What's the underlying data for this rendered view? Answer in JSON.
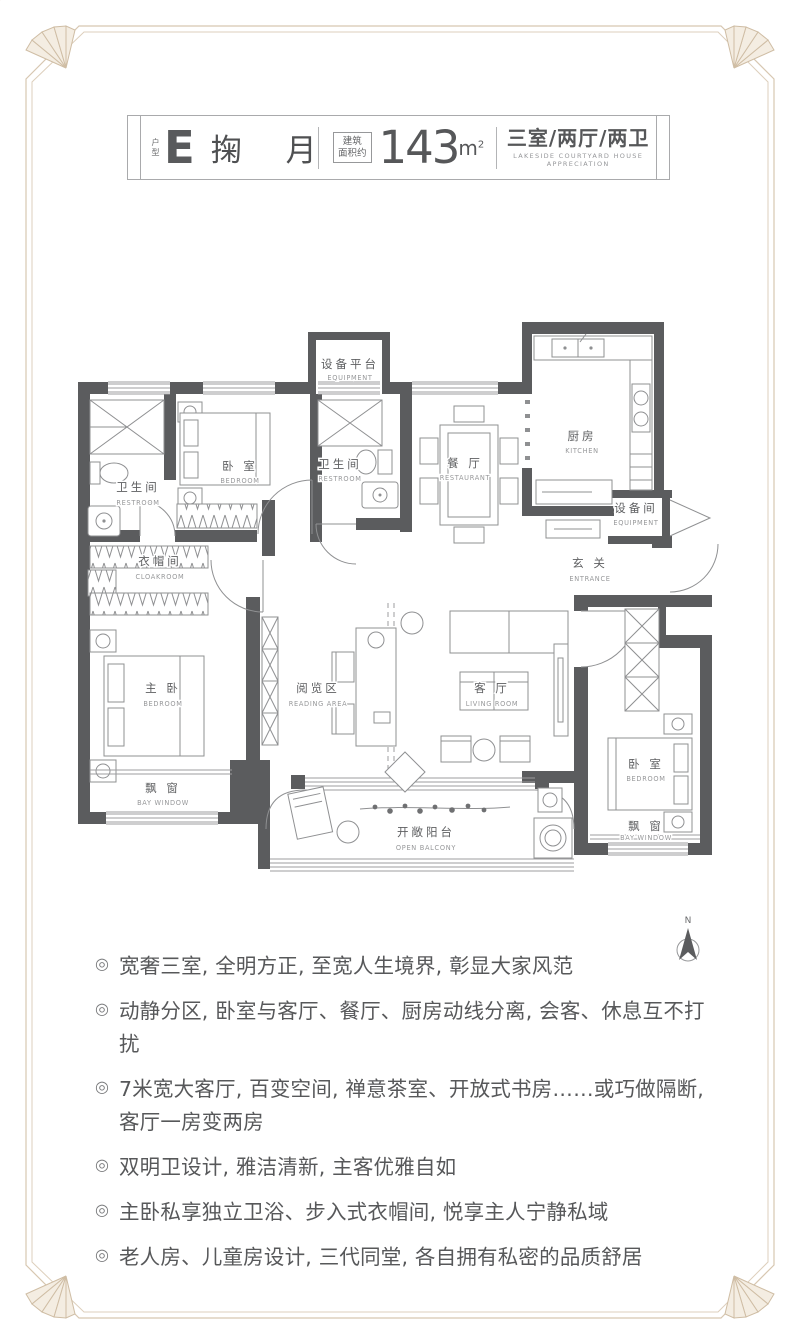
{
  "header": {
    "unit_prefix": "户型",
    "unit_letter": "E",
    "unit_name": "掬 月",
    "area_label_line1": "建筑",
    "area_label_line2": "面积约",
    "area_value": "143",
    "area_unit_m": "m",
    "area_unit_sup": "2",
    "layout": "三室/两厅/两卫",
    "layout_en": "LAKESIDE COURTYARD HOUSE APPRECIATION"
  },
  "floorplan": {
    "rooms": [
      {
        "id": "equipment-platform",
        "zh": "设备平台",
        "en": "EQUIPMENT"
      },
      {
        "id": "kitchen",
        "zh": "厨房",
        "en": "KITCHEN"
      },
      {
        "id": "dining",
        "zh": "餐 厅",
        "en": "RESTAURANT"
      },
      {
        "id": "restroom-left",
        "zh": "卫生间",
        "en": "RESTROOM"
      },
      {
        "id": "bedroom-top",
        "zh": "卧 室",
        "en": "BEDROOM"
      },
      {
        "id": "restroom-middle",
        "zh": "卫生间",
        "en": "RESTROOM"
      },
      {
        "id": "equipment-room",
        "zh": "设备间",
        "en": "EQUIPMENT"
      },
      {
        "id": "entrance",
        "zh": "玄 关",
        "en": "ENTRANCE"
      },
      {
        "id": "cloakroom",
        "zh": "衣帽间",
        "en": "CLOAKROOM"
      },
      {
        "id": "master-bedroom",
        "zh": "主 卧",
        "en": "BEDROOM"
      },
      {
        "id": "reading-area",
        "zh": "阅览区",
        "en": "READING AREA"
      },
      {
        "id": "living-room",
        "zh": "客 厅",
        "en": "LIVING ROOM"
      },
      {
        "id": "bedroom-right",
        "zh": "卧 室",
        "en": "BEDROOM"
      },
      {
        "id": "bay-window-left",
        "zh": "飘 窗",
        "en": "BAY WINDOW"
      },
      {
        "id": "bay-window-right",
        "zh": "飘 窗",
        "en": "BAY WINDOW"
      },
      {
        "id": "open-balcony",
        "zh": "开敞阳台",
        "en": "OPEN BALCONY"
      }
    ],
    "compass_label": "N"
  },
  "features": {
    "bullet": "◎",
    "items": [
      "宽奢三室, 全明方正, 至宽人生境界, 彰显大家风范",
      "动静分区, 卧室与客厅、餐厅、厨房动线分离, 会客、休息互不打扰",
      "7米宽大客厅, 百变空间, 禅意茶室、开放式书房……或巧做隔断, 客厅一房变两房",
      "双明卫设计, 雅洁清新, 主客优雅自如",
      "主卧私享独立卫浴、步入式衣帽间, 悦享主人宁静私域",
      "老人房、儿童房设计, 三代同堂, 各自拥有私密的品质舒居"
    ]
  },
  "colors": {
    "wall": "#5b5c5e",
    "text": "#57585a",
    "frame_border": "#d7c7b1",
    "furniture_line": "#8f9092"
  }
}
